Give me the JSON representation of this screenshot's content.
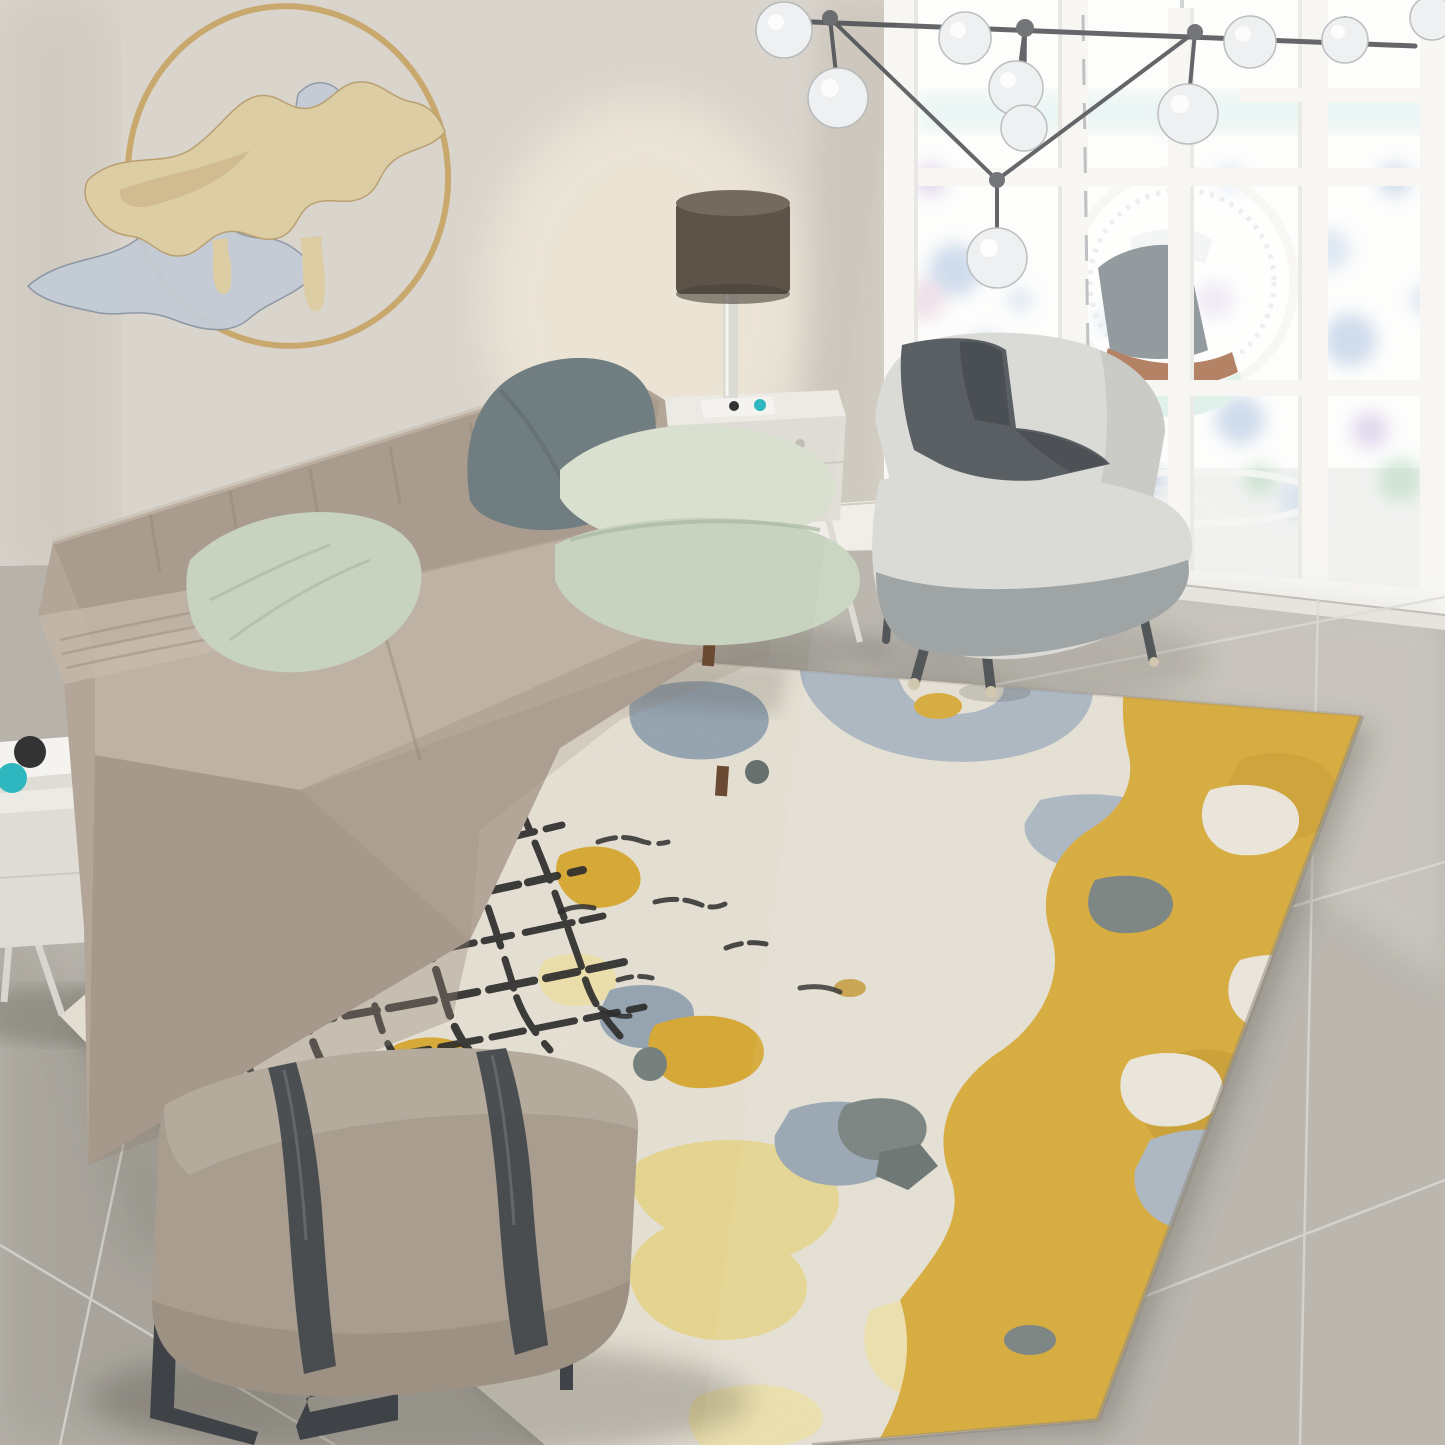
{
  "scene": {
    "kind": "living-room photograph",
    "subject": "modern living room with abstract yellow-grey area rug, taupe leather sofa, accent chair, ottoman bench, bubble chandelier and french-door windows"
  },
  "objects": [
    "wall-art-ring-sculpture",
    "bubble-chandelier",
    "french-door-windows",
    "hanging-egg-chair",
    "leather-sofa",
    "throw-pillows",
    "table-lamp",
    "side-table-left",
    "side-table-right",
    "accent-chair",
    "throw-blanket",
    "ottoman-bench",
    "abstract-area-rug",
    "tile-floor",
    "crackle-grid-pattern",
    "gold-patch-pattern"
  ],
  "palette": {
    "wall": "#d9d4cc",
    "wall_shadow": "#b4ac9f",
    "glow": "#f2ead9",
    "window_frame": "#f7f6f3",
    "frame_shade": "#dcdcd7",
    "glass": "#fdfdfc",
    "glass_floor": "#eef0ed",
    "teal_band": "#bfe6e2",
    "divider": "#8d9296",
    "rod": "#5b5d60",
    "hub": "#6b6d70",
    "glass_ball": "#eef0f1",
    "ball_rim": "#b7babc",
    "gold_ring": "#c8a568",
    "sculpt_gold": "#ddcda4",
    "sculpt_gold_dark": "#c3ab7c",
    "sculpt_silver": "#c3cbd5",
    "baseboard": "#efede7",
    "threshold": "#e9e7e1",
    "floor": "#b7b3ab",
    "floor_light": "#d3d0c8",
    "floor_dark": "#8f8b82",
    "grout": "#dbd8d1",
    "shadow": "#39352c",
    "rug_base": "#e9e4d7",
    "rug_edge": "#8d8679",
    "blue_gray": "#a8b5c2",
    "blue_gray2": "#93a3b2",
    "slate": "#6f7b79",
    "slate2": "#5f6a68",
    "gold": "#d9a82c",
    "gold_deep": "#c08f1c",
    "pale_gold": "#e9d88e",
    "pale_gold2": "#f0e3ab",
    "cream": "#efeadd",
    "crackle": "#202020",
    "sofa": "#b3a698",
    "sofa_dark": "#8f8273",
    "sofa_light": "#c7bcae",
    "wood": "#6b4a33",
    "pillow_mint": "#c7d3bf",
    "pillow_mint_light": "#dae0cf",
    "pillow_mint_dark": "#a9b8a2",
    "pillow_gray": "#707d81",
    "pillow_gray_dark": "#5a676b",
    "table_white": "#eceae4",
    "table_side": "#dfdcd5",
    "knob": "#c2beb5",
    "lamp_shade": "#5d5349",
    "lamp_shade_top": "#756a5e",
    "lamp_stem": "#d9d8d3",
    "book_white": "#f4f3f0",
    "book_teal": "#2fb7c0",
    "book_dark": "#333333",
    "chair_body": "#d8d8d4",
    "chair_body_dark": "#c3c3bf",
    "chair_band": "#9aa0a0",
    "chair_throw": "#50555a",
    "chair_throw_dark": "#3f4449",
    "chair_leg": "#4a4d4f",
    "leg_tip": "#cfc3a9",
    "egg_cushion": "#8d9598",
    "egg_rim": "#b07c5c",
    "egg_seat": "#dff0ea",
    "egg_pillow": "#f3f6f4",
    "ottoman": "#a99d8f",
    "ottoman_light": "#bbb0a2",
    "ottoman_dark": "#8e8375",
    "strap": "#42474b",
    "strap_hl": "#6c7276",
    "metal_leg": "#3f4347",
    "b_blue": "#9db8dc",
    "b_blue2": "#bcd0ea",
    "b_green": "#a8d2b4",
    "b_green2": "#8fd1c4",
    "b_purple": "#c5afdf",
    "b_pink": "#e3c2d4"
  }
}
